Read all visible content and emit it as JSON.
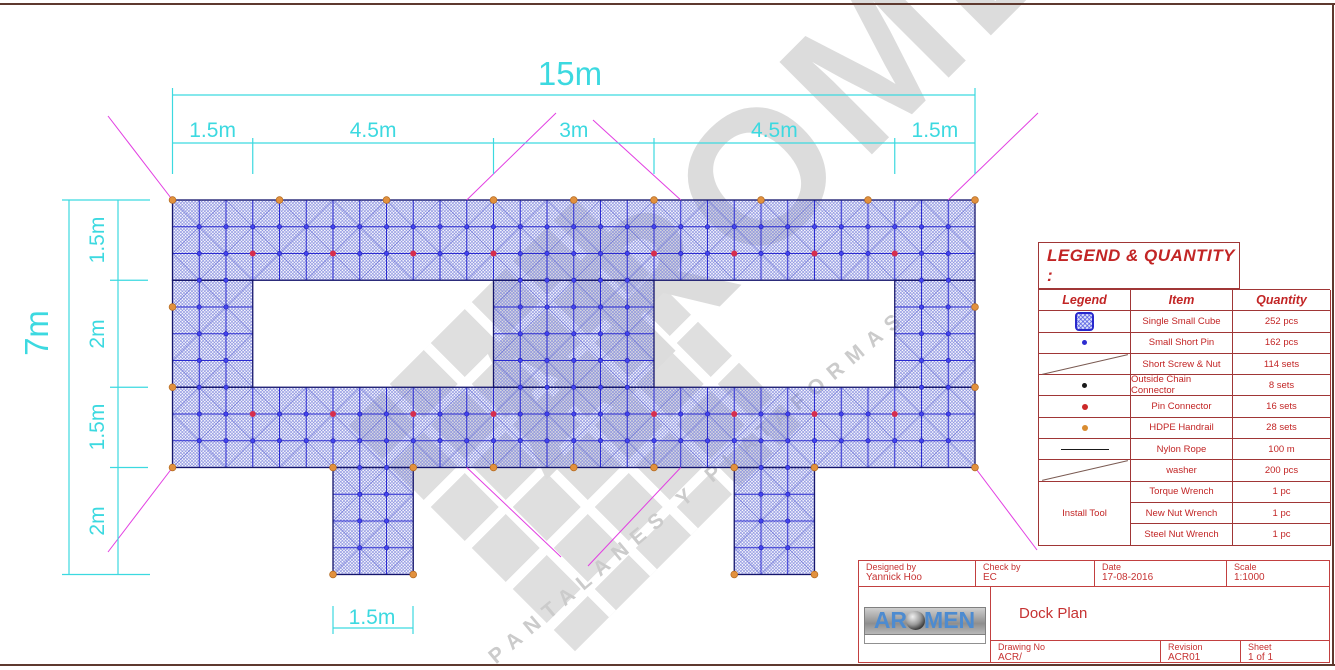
{
  "watermark": {
    "brand": "AROMEN",
    "tagline": "PANTALANES Y PLATAFORMAS"
  },
  "drawing": {
    "colors": {
      "hatch": "#8289dd",
      "grid": "#2b2bd0",
      "celldiag": "#4a52cf",
      "outline": "#15156b",
      "pin_fill": "#4343ee",
      "pin_stroke": "#1d1dae",
      "red_dot": "#d62e4e",
      "orange_fill": "#e2913e",
      "orange_stroke": "#b36a20",
      "leader": "#e23fe2",
      "dim": "#3cd9e0"
    },
    "origin": [
      172.5,
      200
    ],
    "cell": 26.75,
    "rects": [
      [
        0,
        0,
        30,
        3
      ],
      [
        0,
        3,
        3,
        7
      ],
      [
        12,
        3,
        18,
        7
      ],
      [
        27,
        3,
        30,
        7
      ],
      [
        0,
        7,
        30,
        10
      ],
      [
        6,
        10,
        9,
        14
      ],
      [
        21,
        10,
        24,
        14
      ]
    ],
    "red_dots": {
      "rows": [
        2,
        8
      ],
      "cols": [
        3,
        6,
        9,
        12,
        18,
        21,
        24,
        27
      ]
    },
    "orange_dots": [
      [
        0,
        0
      ],
      [
        4,
        0
      ],
      [
        8,
        0
      ],
      [
        12,
        0
      ],
      [
        15,
        0
      ],
      [
        18,
        0
      ],
      [
        22,
        0
      ],
      [
        26,
        0
      ],
      [
        30,
        0
      ],
      [
        0,
        4
      ],
      [
        0,
        7
      ],
      [
        0,
        10
      ],
      [
        30,
        4
      ],
      [
        30,
        7
      ],
      [
        30,
        10
      ],
      [
        6,
        10
      ],
      [
        9,
        10
      ],
      [
        12,
        10
      ],
      [
        15,
        10
      ],
      [
        18,
        10
      ],
      [
        21,
        10
      ],
      [
        24,
        10
      ],
      [
        6,
        14
      ],
      [
        9,
        14
      ],
      [
        21,
        14
      ],
      [
        24,
        14
      ]
    ],
    "leaders": [
      [
        172.5,
        200,
        108,
        116
      ],
      [
        466.75,
        200,
        556,
        113
      ],
      [
        680.75,
        200,
        593,
        120
      ],
      [
        948.25,
        200,
        1038,
        113
      ],
      [
        466.75,
        467.5,
        561,
        557
      ],
      [
        680.75,
        467.5,
        588,
        566
      ],
      [
        172.5,
        467.5,
        108,
        552
      ],
      [
        975,
        467.5,
        1037,
        550
      ]
    ],
    "dim_lines": [
      [
        172.5,
        95,
        975,
        95
      ],
      [
        172.5,
        143,
        975,
        143
      ],
      [
        172.5,
        88,
        172.5,
        174
      ],
      [
        975,
        88,
        975,
        174
      ],
      [
        252.75,
        138,
        252.75,
        174
      ],
      [
        493.5,
        138,
        493.5,
        174
      ],
      [
        654,
        138,
        654,
        174
      ],
      [
        894.75,
        138,
        894.75,
        174
      ],
      [
        69,
        200,
        69,
        574.5
      ],
      [
        118,
        200,
        118,
        574.5
      ],
      [
        62,
        200,
        150,
        200
      ],
      [
        62,
        574.5,
        150,
        574.5
      ],
      [
        110,
        280.25,
        148,
        280.25
      ],
      [
        110,
        387.25,
        148,
        387.25
      ],
      [
        110,
        467.5,
        148,
        467.5
      ],
      [
        333,
        606,
        333,
        634
      ],
      [
        413,
        606,
        413,
        634
      ],
      [
        333,
        628,
        413,
        628
      ]
    ],
    "dim_labels": [
      {
        "text": "15m",
        "x": 570,
        "y": 85,
        "size": 33,
        "rot": 0
      },
      {
        "text": "1.5m",
        "x": 212.6,
        "y": 137,
        "size": 21,
        "rot": 0
      },
      {
        "text": "4.5m",
        "x": 373.1,
        "y": 137,
        "size": 21,
        "rot": 0
      },
      {
        "text": "3m",
        "x": 573.8,
        "y": 137,
        "size": 21,
        "rot": 0
      },
      {
        "text": "4.5m",
        "x": 774.4,
        "y": 137,
        "size": 21,
        "rot": 0
      },
      {
        "text": "1.5m",
        "x": 934.9,
        "y": 137,
        "size": 21,
        "rot": 0
      },
      {
        "text": "7m",
        "x": 48,
        "y": 333,
        "size": 33,
        "rot": -90
      },
      {
        "text": "1.5m",
        "x": 104,
        "y": 240,
        "size": 21,
        "rot": -90
      },
      {
        "text": "2m",
        "x": 104,
        "y": 334,
        "size": 21,
        "rot": -90
      },
      {
        "text": "1.5m",
        "x": 104,
        "y": 427,
        "size": 21,
        "rot": -90
      },
      {
        "text": "2m",
        "x": 104,
        "y": 521,
        "size": 21,
        "rot": -90
      },
      {
        "text": "1.5m",
        "x": 372,
        "y": 624,
        "size": 21,
        "rot": 0
      }
    ]
  },
  "legend": {
    "title": "LEGEND & QUANTITY :",
    "headers": [
      "Legend",
      "Item",
      "Quantity"
    ],
    "install_tool_label": "Install Tool",
    "rows": [
      {
        "symbol": "cube",
        "item": "Single Small Cube",
        "qty": "252 pcs"
      },
      {
        "symbol": "blue-dot",
        "item": "Small Short Pin",
        "qty": "162 pcs"
      },
      {
        "symbol": "diag",
        "item": "Short Screw & Nut",
        "qty": "114 sets"
      },
      {
        "symbol": "black-dot",
        "item": "Outside Chain Connector",
        "qty": "8 sets"
      },
      {
        "symbol": "red-dot",
        "item": "Pin Connector",
        "qty": "16 sets"
      },
      {
        "symbol": "orange-dot",
        "item": "HDPE Handrail",
        "qty": "28 sets"
      },
      {
        "symbol": "h-line",
        "item": "Nylon Rope",
        "qty": "100 m"
      },
      {
        "symbol": "diag",
        "item": "washer",
        "qty": "200 pcs"
      },
      {
        "symbol": "install",
        "item": "Torque Wrench",
        "qty": "1 pc"
      },
      {
        "symbol": "",
        "item": "New Nut Wrench",
        "qty": "1 pc"
      },
      {
        "symbol": "",
        "item": "Steel Nut Wrench",
        "qty": "1 pc"
      }
    ]
  },
  "title_block": {
    "designed_by_label": "Designed by",
    "designed_by": "Yannick Hoo",
    "check_by_label": "Check by",
    "check_by": "EC",
    "date_label": "Date",
    "date": "17-08-2016",
    "scale_label": "Scale",
    "scale": "1:1000",
    "title": "Dock Plan",
    "drawing_no_label": "Drawing No",
    "drawing_no": "ACR/",
    "revision_label": "Revision",
    "revision": "ACR01",
    "sheet_label": "Sheet",
    "sheet": "1 of 1",
    "logo": {
      "left": "AR",
      "right": "MEN"
    }
  }
}
